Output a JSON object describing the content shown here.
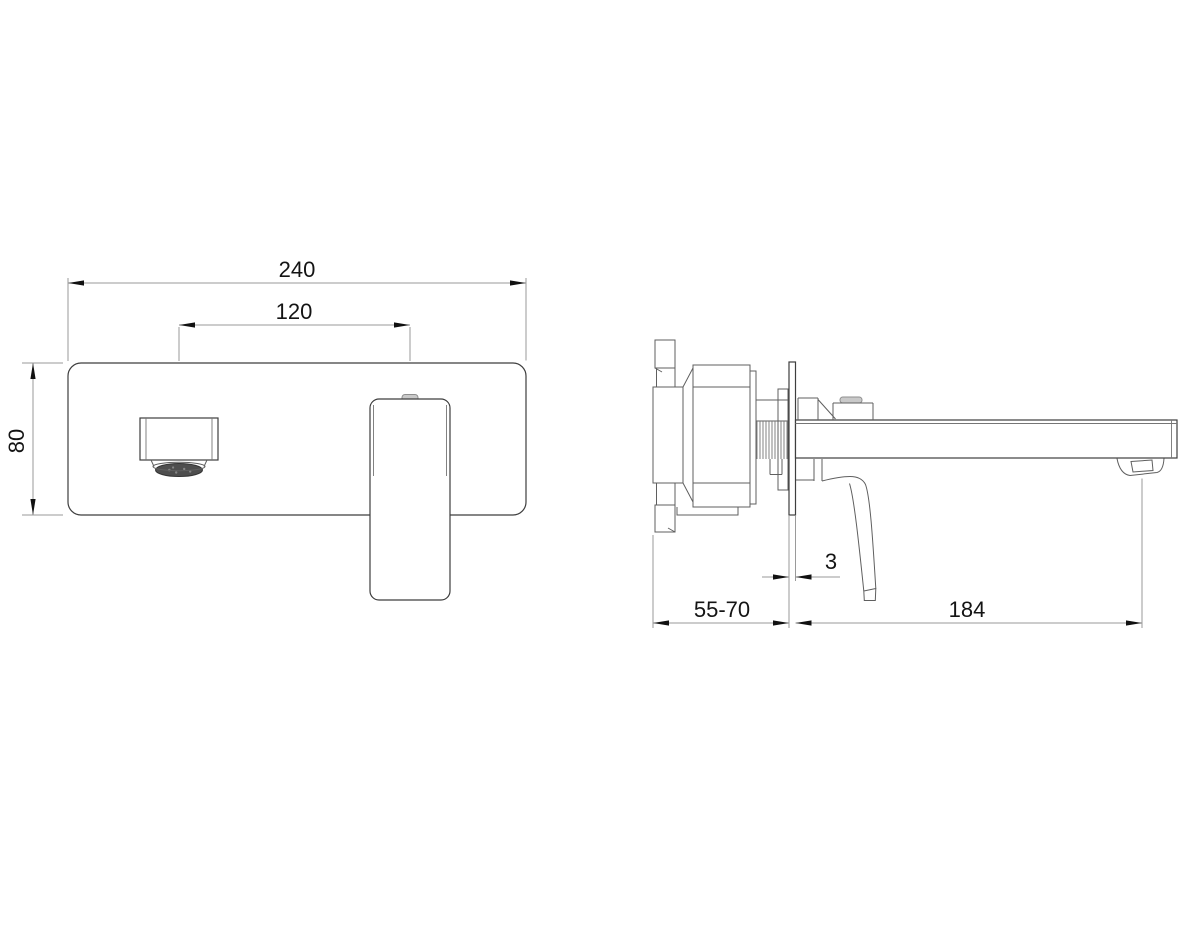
{
  "drawing": {
    "type": "technical-dimension-drawing",
    "subject": "wall-mounted basin mixer faucet, front and side views",
    "views": {
      "front": {
        "dims": {
          "overall_width": "240",
          "spout_to_handle": "120",
          "plate_height": "80"
        }
      },
      "side": {
        "dims": {
          "wall_depth_range": "55-70",
          "plate_thickness": "3",
          "spout_reach": "184"
        }
      }
    },
    "colors": {
      "background": "#ffffff",
      "part_line": "#3e3e3e",
      "secondary_line": "#5f5f5f",
      "dimension_line": "#9a9a9a",
      "arrow_and_text": "#111111",
      "cap_fill": "#c9c9c9",
      "aerator_fill": "#4e4e4e"
    }
  }
}
